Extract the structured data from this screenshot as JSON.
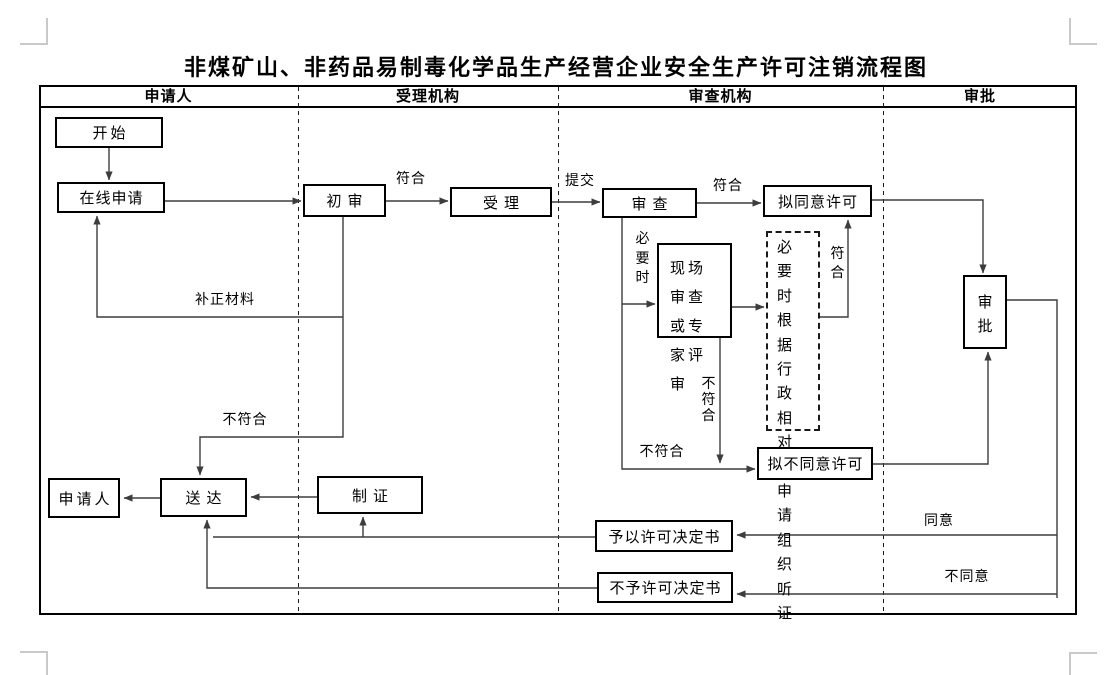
{
  "title": "非煤矿山、非药品易制毒化学品生产经营企业安全生产许可注销流程图",
  "lanes": {
    "applicant": "申请人",
    "acceptor": "受理机构",
    "reviewer": "审查机构",
    "approver": "审批"
  },
  "nodes": {
    "start": "开始",
    "online_application": "在线申请",
    "initial_review": "初审",
    "accept": "受理",
    "examine": "审查",
    "propose_approve": "拟同意许可",
    "onsite_review": "现场审查或专家评审",
    "hearing": "必要时根据行政相对人申请组织听证",
    "approve": "审批",
    "propose_disapprove": "拟不同意许可",
    "applicant_node": "申请人",
    "deliver": "送达",
    "make_certificate": "制证",
    "grant_decision": "予以许可决定书",
    "deny_decision": "不予许可决定书"
  },
  "labels": {
    "conform_initial": "符合",
    "submit": "提交",
    "conform_examine": "符合",
    "when_necessary": "必要时",
    "conform_hearing": "符合",
    "not_conform_onsite": "不符合",
    "supplement_materials": "补正材料",
    "not_conform_initial": "不符合",
    "not_conform_examine": "不符合",
    "agree": "同意",
    "disagree": "不同意"
  },
  "colors": {
    "line": "#3d3d3d",
    "border": "#000000",
    "crop_mark": "#c9c9c9",
    "background": "#ffffff"
  }
}
